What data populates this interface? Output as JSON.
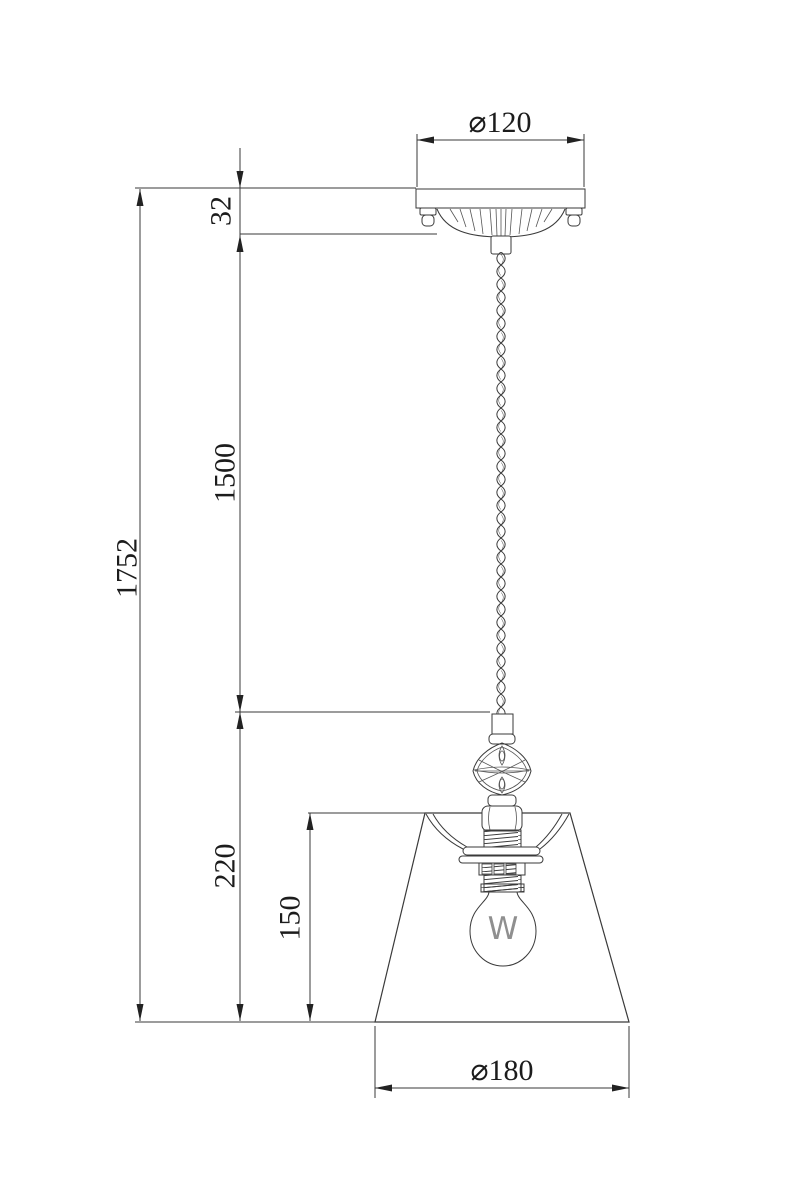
{
  "dimensions": {
    "canopy_diameter": "⌀120",
    "canopy_height": "32",
    "cord_length": "1500",
    "total_height": "1752",
    "shade_assembly_height": "220",
    "bulb_zone_height": "150",
    "shade_diameter": "⌀180"
  },
  "bulb": {
    "marking": "W"
  },
  "colors": {
    "line": "#3a3a3a",
    "text": "#1c1c1c",
    "background": "#ffffff"
  }
}
